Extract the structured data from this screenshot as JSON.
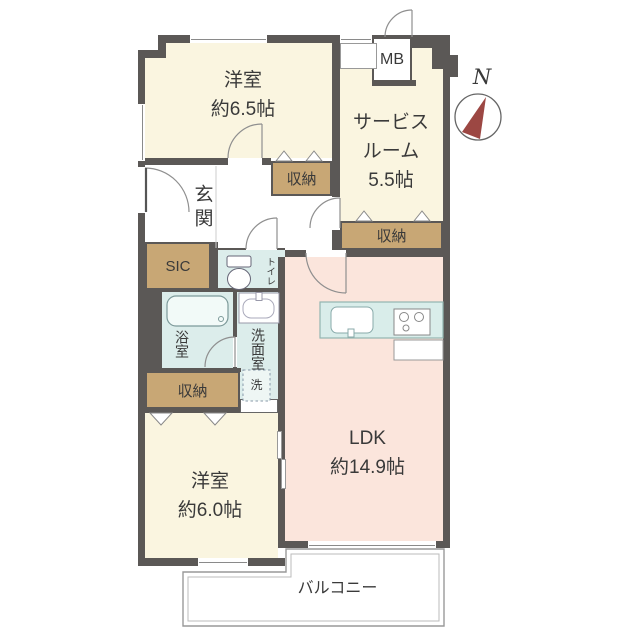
{
  "plan": {
    "rooms": {
      "bedroom_65": {
        "name": "洋室",
        "size": "約6.5帖"
      },
      "service_room": {
        "name_line1": "サービス",
        "name_line2": "ルーム",
        "size": "5.5帖"
      },
      "ldk": {
        "name": "LDK",
        "size": "約14.9帖"
      },
      "bedroom_60": {
        "name": "洋室",
        "size": "約6.0帖"
      },
      "entrance": {
        "name": "玄関"
      },
      "balcony": {
        "name": "バルコニー"
      },
      "toilet": {
        "name": "トイレ"
      },
      "bathroom": {
        "name": "浴室"
      },
      "washroom": {
        "name": "洗面室"
      }
    },
    "labels": {
      "storage": "収納",
      "shoe_closet": "SIC",
      "laundry": "洗",
      "meter_box": "MB",
      "compass_north": "N"
    },
    "colors": {
      "wall": "#5b5856",
      "cream": "#faf5e0",
      "pink": "#fbe5dc",
      "blue": "#dcedeb",
      "tan": "#c8a775",
      "red": "#9c4743",
      "ink": "#3a3a3a"
    }
  }
}
